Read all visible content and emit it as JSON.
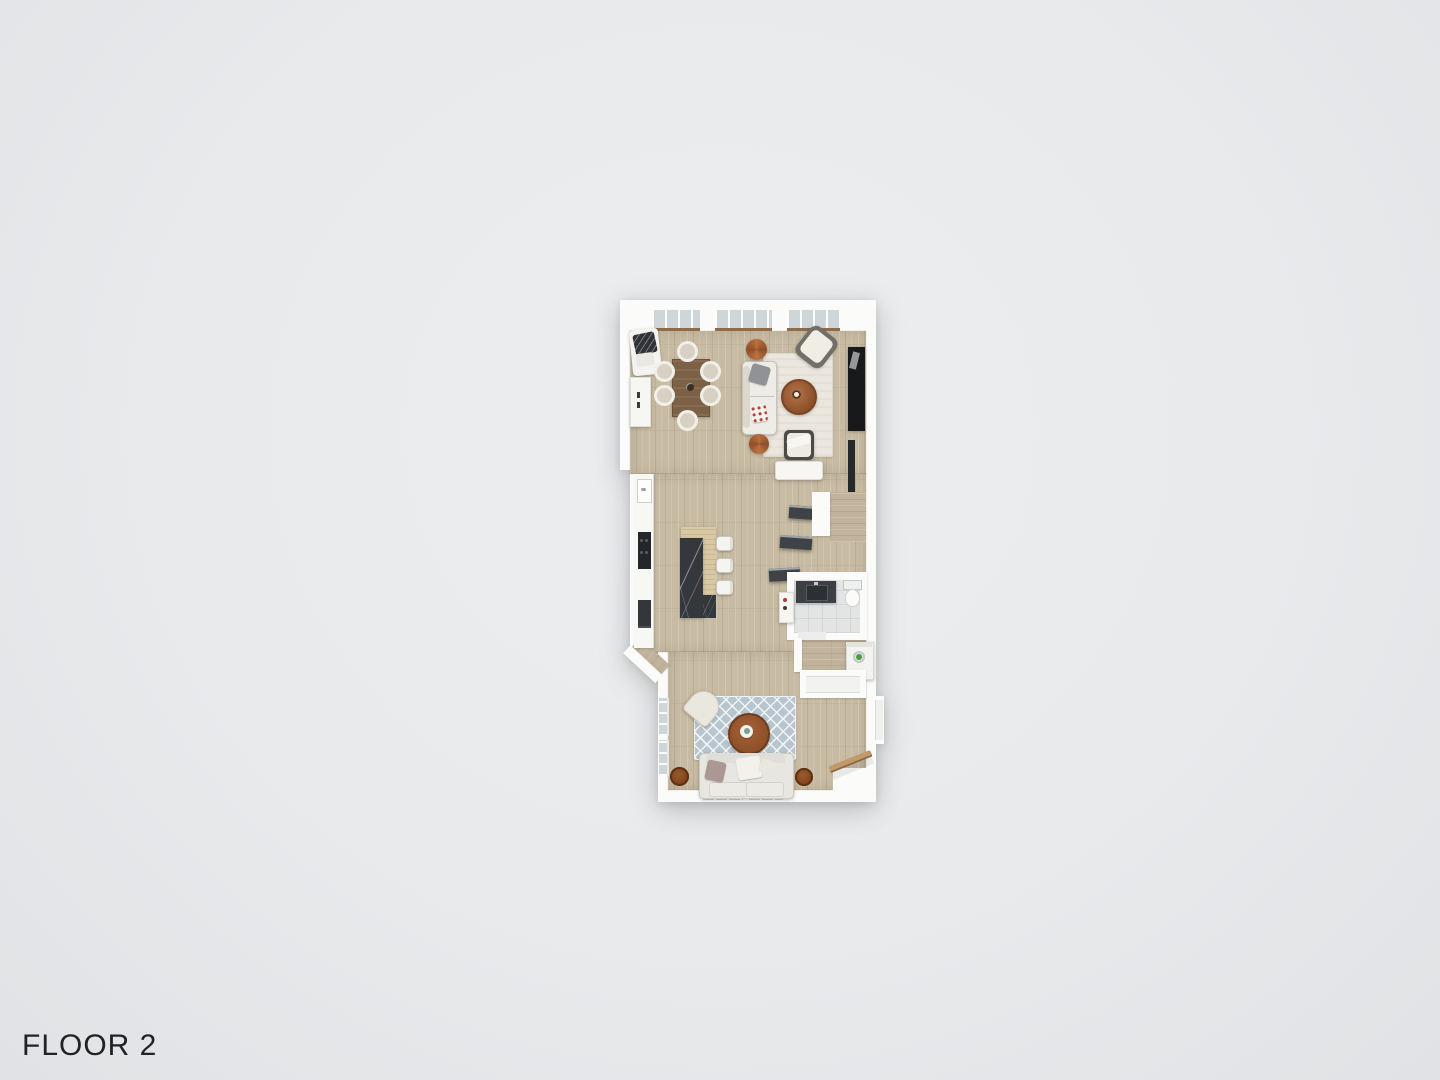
{
  "floor_label": "FLOOR 2",
  "palette": {
    "background": "#e8eaec",
    "wall": "#fbfbfa",
    "floor_wood": "#c8bba3",
    "floor_wood_dark": "#c2b49c",
    "tile": "#e2e5e4",
    "window_glass": "#cfd6da",
    "window_sill": "#8f6b4a",
    "rug_living": "#ebe7de",
    "rug_family": "#b7c5cf",
    "marble": "#34373c",
    "island_wood": "#d8c8a3",
    "table_wood": "#7d6147",
    "accent_wood": "#9a5c32",
    "pouf": "#ac6034",
    "dark_furniture": "#17191b",
    "appliance_green": "#4d9c3c",
    "text": "#202224"
  },
  "plan": {
    "furniture_icons": [
      "dining-table",
      "dining-chair",
      "corner-lounge",
      "kitchen-cabinet",
      "kitchen-counter",
      "sink",
      "cooktop",
      "oven",
      "kitchen-island",
      "bar-stool",
      "living-rug",
      "living-sofa",
      "coffee-table",
      "pouf",
      "armchair",
      "tv-console",
      "media-bench",
      "stair-tread",
      "stair-landing",
      "stair-closet",
      "bathroom-vanity",
      "toilet",
      "storage-cabinet",
      "washing-machine",
      "hall-closet",
      "family-rug",
      "family-armchair",
      "family-coffee-table",
      "family-sofa",
      "side-table",
      "stair-railing"
    ]
  }
}
